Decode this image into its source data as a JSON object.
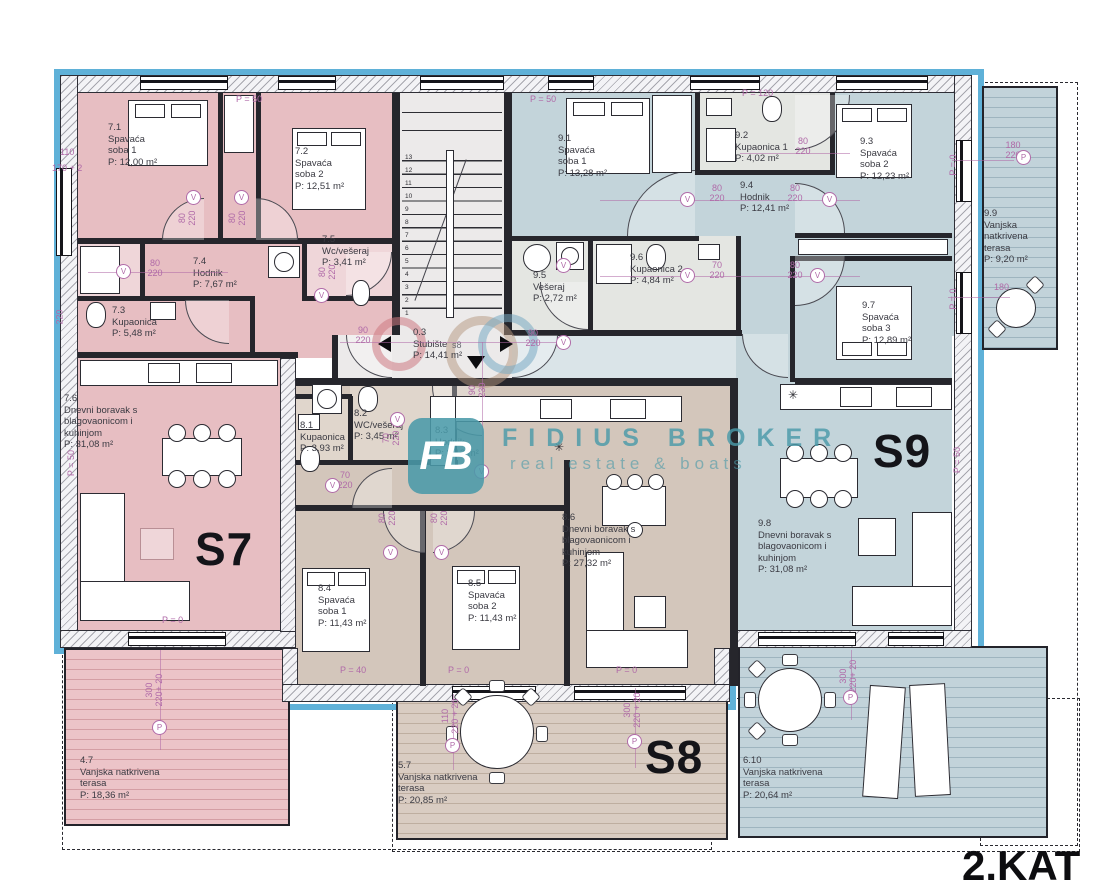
{
  "floor_label": "2.KAT",
  "logo": {
    "monogram": "FB",
    "name": "FIDIUS BROKER",
    "tagline": "real estate & boats"
  },
  "apartments": {
    "s7": "S7",
    "s8": "S8",
    "s9": "S9"
  },
  "entry": {
    "s8_small": "s8"
  },
  "markers": {
    "v": "V",
    "p": "P"
  },
  "misc": {
    "star": "✳"
  },
  "stairs": {
    "numbers": [
      "1",
      "2",
      "3",
      "4",
      "5",
      "6",
      "7",
      "8",
      "9",
      "10",
      "11",
      "12",
      "13"
    ]
  },
  "rooms": [
    {
      "num": "7.1",
      "l1": "Spavaća",
      "l2": "soba 1",
      "area": "P: 12,00 m²"
    },
    {
      "num": "7.2",
      "l1": "Spavaća",
      "l2": "soba 2",
      "area": "P: 12,51 m²"
    },
    {
      "num": "7.3",
      "l1": "Kupaonica",
      "area": "P: 5,48 m²"
    },
    {
      "num": "7.4",
      "l1": "Hodnik",
      "area": "P: 7,67 m²"
    },
    {
      "num": "7.5",
      "l1": "Wc/vešeraj",
      "area": "P: 3,41 m²"
    },
    {
      "num": "7.6",
      "l1": "Dnevni boravak s",
      "l2": "blagovaonicom i",
      "l3": "kuhinjom",
      "area": "P: 31,08 m²"
    },
    {
      "num": "8.1",
      "l1": "Kupaonica",
      "area": "P: 3,93 m²"
    },
    {
      "num": "8.2",
      "l1": "WC/vešeraj",
      "area": "P: 3,45 m²"
    },
    {
      "num": "8.3",
      "l1": "Hodnik",
      "area": "P: 8,12 m²"
    },
    {
      "num": "8.4",
      "l1": "Spavaća",
      "l2": "soba 1",
      "area": "P: 11,43 m²"
    },
    {
      "num": "8.5",
      "l1": "Spavaća",
      "l2": "soba 2",
      "area": "P: 11,43 m²"
    },
    {
      "num": "8.6",
      "l1": "Dnevni boravak s",
      "l2": "blagovaonicom i",
      "l3": "kuhinjom",
      "area": "P: 27,32 m²"
    },
    {
      "num": "9.1",
      "l1": "Spavaća",
      "l2": "soba 1",
      "area": "P: 13,28 m²"
    },
    {
      "num": "9.2",
      "l1": "Kupaonica 1",
      "area": "P: 4,02 m²"
    },
    {
      "num": "9.3",
      "l1": "Spavaća",
      "l2": "soba 2",
      "area": "P: 12,23 m²"
    },
    {
      "num": "9.4",
      "l1": "Hodnik",
      "area": "P: 12,41 m²"
    },
    {
      "num": "9.5",
      "l1": "Vešeraj",
      "area": "P: 2,72 m²"
    },
    {
      "num": "9.6",
      "l1": "Kupaonica 2",
      "area": "P: 4,84 m²"
    },
    {
      "num": "9.7",
      "l1": "Spavaća",
      "l2": "soba 3",
      "area": "P: 12,89 m²"
    },
    {
      "num": "9.8",
      "l1": "Dnevni boravak s",
      "l2": "blagovaonicom i",
      "l3": "kuhinjom",
      "area": "P: 31,08 m²"
    },
    {
      "num": "0.3",
      "l1": "Stubište",
      "area": "P: 14,41 m²"
    },
    {
      "num": "4.7",
      "l1": "Vanjska natkrivena",
      "l2": "terasa",
      "area": "P: 18,36 m²"
    },
    {
      "num": "5.7",
      "l1": "Vanjska natkrivena",
      "l2": "terasa",
      "area": "P: 20,85 m²"
    },
    {
      "num": "6.10",
      "l1": "Vanjska natkrivena",
      "l2": "terasa",
      "area": "P: 20,64 m²"
    },
    {
      "num": "9.9",
      "l1": "Vanjska",
      "l2": "natkrivena",
      "l3": "terasa",
      "area": "P: 9,20 m²"
    }
  ],
  "dims": [
    "P = 50",
    "P = 50",
    "P = 120",
    "110",
    "170 + 2",
    "220",
    "80\n220",
    "80\n220",
    "80\n220",
    "80\n220",
    "90\n220",
    "90\n220",
    "90\n230",
    "70\n220",
    "70\n220",
    "80\n220",
    "80\n220",
    "80\n220",
    "80\n220",
    "80\n220",
    "70\n220",
    "80\n220",
    "180\n220",
    "180",
    "P = 0",
    "P = 0",
    "P = 50",
    "P = 50",
    "P = 0",
    "P = 40",
    "P = 0",
    "P = 0",
    "300\n220+ 20",
    "110\n220 + 20",
    "300\n220 + 20",
    "300\n220+ 20"
  ],
  "colors": {
    "accent": "#5fb1d8",
    "wall": "#26262c",
    "ink": "#141419",
    "pink": "#e7bec2",
    "pinkLight": "#efd6d9",
    "tan": "#d3c6bb",
    "tanLight": "#e0d6cc",
    "blue": "#c3d4da",
    "blueLight": "#dae4e8",
    "gray": "#eceaea",
    "bathGray": "#e4e6e2",
    "terracePink": "#ecc4c8",
    "terraceTan": "#d9ccc2",
    "terraceBlue": "#c2d3da",
    "dimPurple": "#b06aa8",
    "logoTeal": "#4f9fac"
  }
}
